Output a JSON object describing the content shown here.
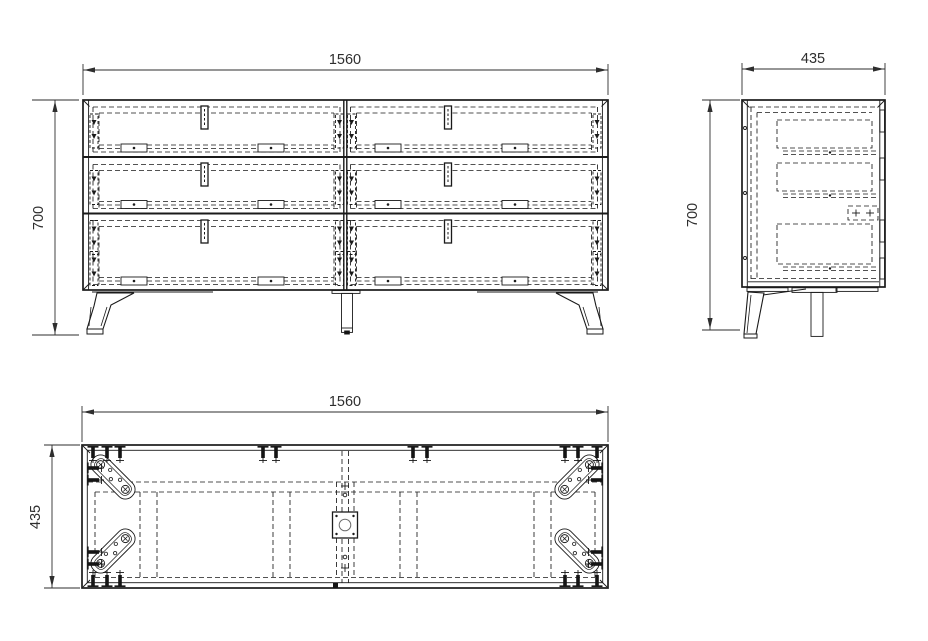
{
  "drawing": {
    "background": "#ffffff",
    "line_color": "#1a1a1a",
    "dimension_text_color": "#2e2e2e",
    "views": {
      "front": {
        "width_label": "1560",
        "height_label": "700"
      },
      "side": {
        "width_label": "435",
        "height_label": "700"
      },
      "plan": {
        "width_label": "1560",
        "depth_label": "435"
      }
    }
  }
}
